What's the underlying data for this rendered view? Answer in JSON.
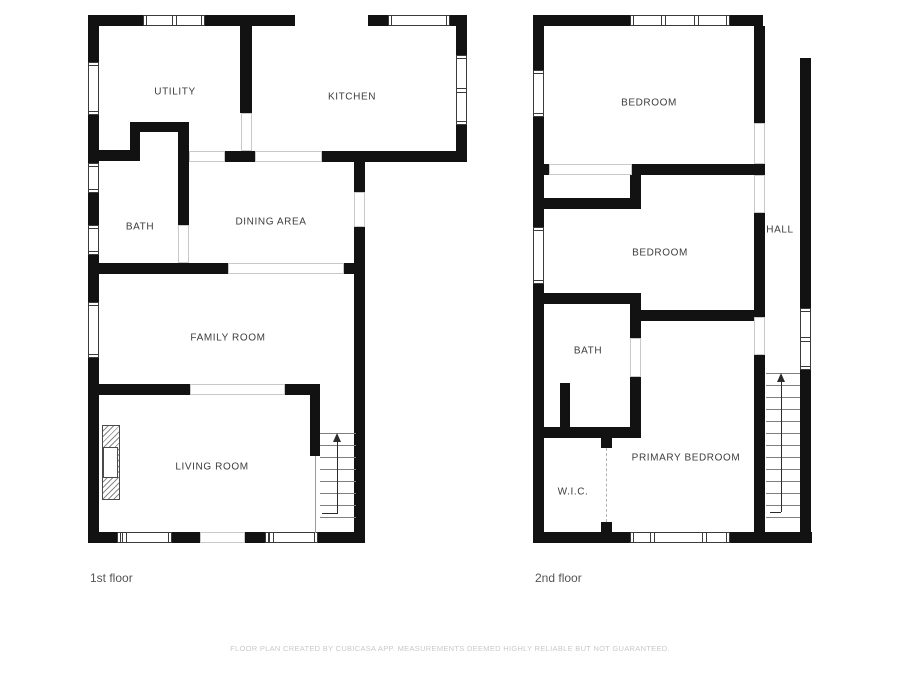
{
  "footer": {
    "text": "FLOOR PLAN CREATED BY CUBICASA APP. MEASUREMENTS DEEMED HIGHLY RELIABLE BUT NOT GUARANTEED."
  },
  "colors": {
    "wall": "#121212",
    "window_border": "#3a3a3a",
    "opening_border": "#c9c9c9",
    "tread": "#7f7f7f",
    "label": "#3c3c3c",
    "floor_label": "#545454",
    "footer": "#c9c9c9"
  },
  "floors": [
    {
      "label": {
        "text": "1st floor"
      },
      "room_labels": [
        {
          "text": "UTILITY",
          "x": 175,
          "y": 92
        },
        {
          "text": "KITCHEN",
          "x": 352,
          "y": 97
        },
        {
          "text": "BATH",
          "x": 140,
          "y": 227
        },
        {
          "text": "DINING AREA",
          "x": 271,
          "y": 222
        },
        {
          "text": "FAMILY ROOM",
          "x": 228,
          "y": 338
        },
        {
          "text": "LIVING ROOM",
          "x": 212,
          "y": 467
        }
      ],
      "walls": [
        [
          88,
          15,
          207,
          11
        ],
        [
          368,
          15,
          99,
          11
        ],
        [
          88,
          15,
          11,
          528
        ],
        [
          456,
          15,
          11,
          147
        ],
        [
          240,
          26,
          12,
          87
        ],
        [
          88,
          150,
          42,
          11
        ],
        [
          130,
          122,
          59,
          10
        ],
        [
          130,
          122,
          10,
          39
        ],
        [
          178,
          122,
          11,
          103
        ],
        [
          225,
          151,
          30,
          11
        ],
        [
          322,
          151,
          145,
          11
        ],
        [
          354,
          162,
          11,
          30
        ],
        [
          354,
          227,
          11,
          316
        ],
        [
          88,
          263,
          140,
          11
        ],
        [
          344,
          263,
          21,
          11
        ],
        [
          178,
          263,
          11,
          11
        ],
        [
          88,
          384,
          102,
          11
        ],
        [
          285,
          384,
          35,
          11
        ],
        [
          310,
          394,
          10,
          62
        ],
        [
          88,
          532,
          112,
          11
        ],
        [
          245,
          532,
          120,
          11
        ]
      ],
      "windows": [
        {
          "x": 143,
          "y": 15,
          "w": 62,
          "h": 11,
          "dir": "h",
          "mullions": [
            0.5
          ]
        },
        {
          "x": 388,
          "y": 15,
          "w": 62,
          "h": 11,
          "dir": "h",
          "mullions": []
        },
        {
          "x": 88,
          "y": 62,
          "w": 11,
          "h": 53,
          "dir": "v",
          "mullions": []
        },
        {
          "x": 456,
          "y": 55,
          "w": 11,
          "h": 70,
          "dir": "v",
          "mullions": [
            0.5
          ]
        },
        {
          "x": 88,
          "y": 163,
          "w": 11,
          "h": 30,
          "dir": "v",
          "mullions": []
        },
        {
          "x": 88,
          "y": 225,
          "w": 11,
          "h": 30,
          "dir": "v",
          "mullions": []
        },
        {
          "x": 88,
          "y": 302,
          "w": 11,
          "h": 56,
          "dir": "v",
          "mullions": []
        },
        {
          "x": 117,
          "y": 532,
          "w": 55,
          "h": 11,
          "dir": "h",
          "mullions": [
            0.12
          ]
        },
        {
          "x": 265,
          "y": 532,
          "w": 53,
          "h": 11,
          "dir": "h",
          "mullions": [
            0.12
          ]
        }
      ],
      "openings": [
        [
          241,
          113,
          11,
          38
        ],
        [
          189,
          151,
          36,
          11
        ],
        [
          255,
          151,
          67,
          11
        ],
        [
          354,
          192,
          11,
          35
        ],
        [
          178,
          225,
          11,
          38
        ],
        [
          228,
          263,
          116,
          11
        ],
        [
          190,
          384,
          95,
          11
        ],
        [
          200,
          532,
          45,
          11
        ]
      ],
      "stairs": {
        "x": 320,
        "y": 433,
        "w": 36,
        "treads": 8,
        "step": 12,
        "arrow": {
          "x": 337,
          "headY": 433,
          "lineY1": 441,
          "lineY2": 514,
          "elbow": {
            "x1": 322,
            "x2": 337,
            "y": 513
          }
        },
        "sidelines": [
          [
            315,
            456,
            1,
            77
          ]
        ]
      },
      "fireplace": {
        "outer": [
          102,
          425,
          18,
          75
        ],
        "inner": [
          103,
          447,
          15,
          31
        ]
      }
    },
    {
      "label": {
        "text": "2nd floor"
      },
      "room_labels": [
        {
          "text": "BEDROOM",
          "x": 649,
          "y": 103
        },
        {
          "text": "BEDROOM",
          "x": 660,
          "y": 253
        },
        {
          "text": "HALL",
          "x": 780,
          "y": 230
        },
        {
          "text": "BATH",
          "x": 588,
          "y": 351
        },
        {
          "text": "PRIMARY BEDROOM",
          "x": 686,
          "y": 458
        },
        {
          "text": "W.I.C.",
          "x": 573,
          "y": 492
        }
      ],
      "walls": [
        [
          533,
          15,
          230,
          11
        ],
        [
          533,
          15,
          11,
          528
        ],
        [
          754,
          26,
          11,
          97
        ],
        [
          533,
          164,
          16,
          11
        ],
        [
          632,
          164,
          133,
          11
        ],
        [
          630,
          164,
          11,
          45
        ],
        [
          544,
          198,
          97,
          11
        ],
        [
          754,
          213,
          11,
          104
        ],
        [
          640,
          310,
          115,
          11
        ],
        [
          544,
          293,
          97,
          11
        ],
        [
          630,
          293,
          11,
          45
        ],
        [
          630,
          377,
          11,
          56
        ],
        [
          560,
          383,
          10,
          50
        ],
        [
          544,
          427,
          97,
          11
        ],
        [
          601,
          438,
          11,
          10
        ],
        [
          601,
          522,
          11,
          10
        ],
        [
          754,
          355,
          11,
          182
        ],
        [
          800,
          58,
          11,
          485
        ],
        [
          533,
          532,
          279,
          11
        ]
      ],
      "windows": [
        {
          "x": 630,
          "y": 15,
          "w": 100,
          "h": 11,
          "dir": "h",
          "mullions": [
            0.33,
            0.66
          ]
        },
        {
          "x": 533,
          "y": 70,
          "w": 11,
          "h": 47,
          "dir": "v",
          "mullions": []
        },
        {
          "x": 533,
          "y": 227,
          "w": 11,
          "h": 57,
          "dir": "v",
          "mullions": []
        },
        {
          "x": 800,
          "y": 308,
          "w": 11,
          "h": 62,
          "dir": "v",
          "mullions": [
            0.5
          ]
        },
        {
          "x": 630,
          "y": 532,
          "w": 100,
          "h": 11,
          "dir": "h",
          "mullions": [
            0.22,
            0.74
          ]
        }
      ],
      "openings": [
        [
          754,
          123,
          11,
          41
        ],
        [
          549,
          164,
          83,
          11
        ],
        [
          754,
          175,
          11,
          38
        ],
        [
          754,
          317,
          11,
          38
        ],
        [
          630,
          338,
          11,
          39
        ]
      ],
      "stairs": {
        "x": 766,
        "y": 373,
        "w": 34,
        "treads": 13,
        "step": 12,
        "arrow": {
          "x": 781,
          "headY": 373,
          "lineY1": 381,
          "lineY2": 512,
          "elbow": {
            "x1": 770,
            "x2": 781,
            "y": 512
          }
        },
        "sidelines": []
      },
      "wic_divider": {
        "x": 606,
        "y": 448,
        "h": 74
      }
    }
  ]
}
